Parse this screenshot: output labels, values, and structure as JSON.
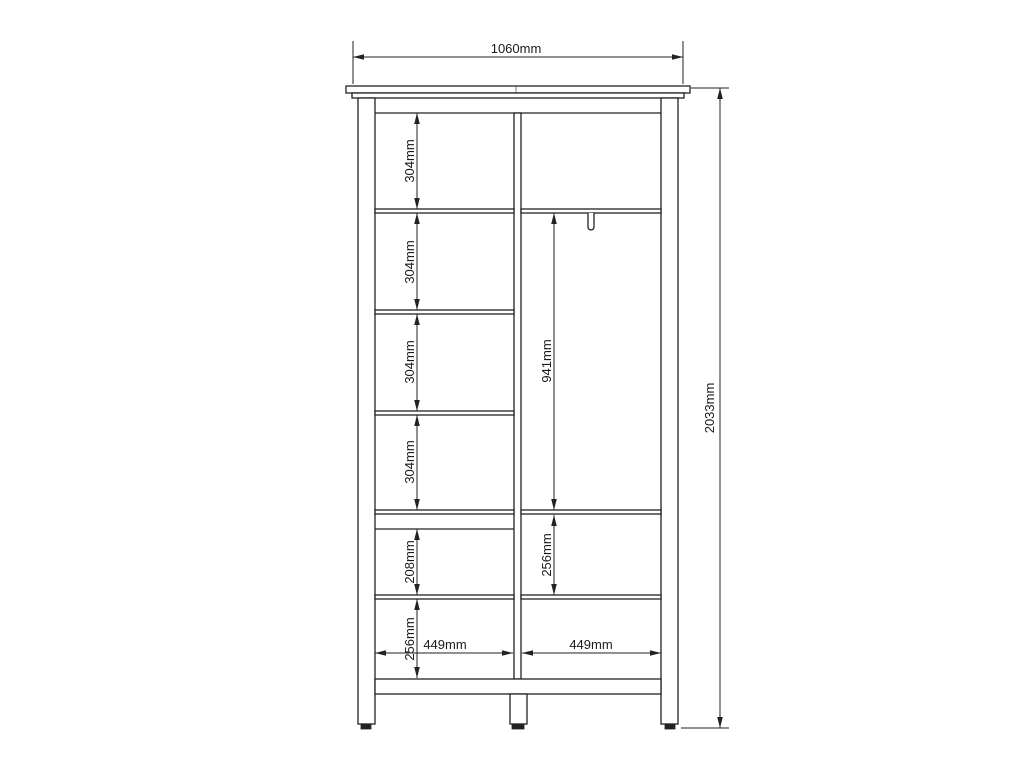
{
  "drawing": {
    "type": "furniture-dimension-diagram",
    "view": "wardrobe front elevation",
    "colors": {
      "background": "#ffffff",
      "line": "#222222",
      "text": "#1a1a1a"
    }
  },
  "dimensions": {
    "overall_width": "1060mm",
    "overall_height": "2033mm",
    "left_column_segments": [
      "304mm",
      "304mm",
      "304mm",
      "304mm",
      "208mm",
      "256mm"
    ],
    "right_column_segments": [
      "941mm",
      "256mm"
    ],
    "compartment_widths": [
      "449mm",
      "449mm"
    ]
  }
}
